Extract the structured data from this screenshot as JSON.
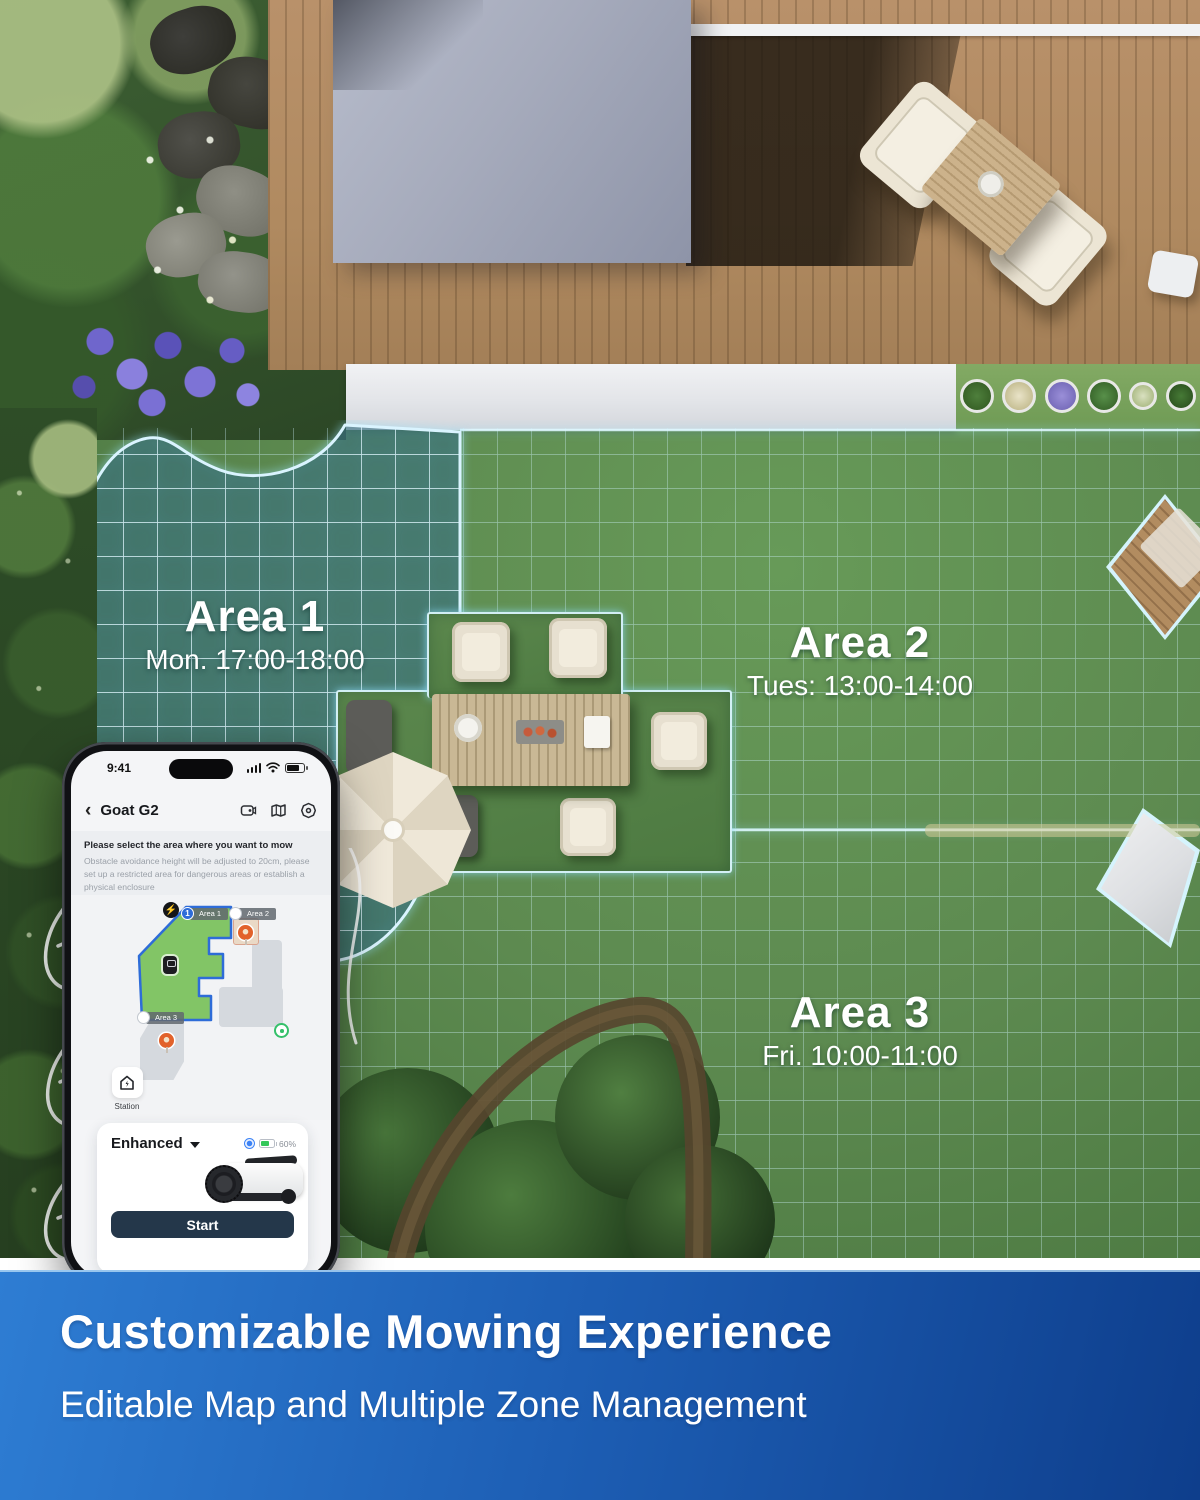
{
  "scene": {
    "areas": [
      {
        "name": "Area 1",
        "schedule": "Mon. 17:00-18:00"
      },
      {
        "name": "Area 2",
        "schedule": "Tues: 13:00-14:00"
      },
      {
        "name": "Area 3",
        "schedule": "Fri. 10:00-11:00"
      }
    ]
  },
  "phone": {
    "status": {
      "time": "9:41"
    },
    "header": {
      "back": "‹",
      "title": "Goat G2"
    },
    "notice": {
      "title": "Please select the area where you want to mow",
      "body": "Obstacle avoidance height will be adjusted to 20cm, please set up a restricted area for dangerous areas or establish a physical enclosure"
    },
    "map": {
      "area1": {
        "index": "1",
        "label": "Area 1"
      },
      "area2": {
        "label": "Area 2"
      },
      "area3": {
        "label": "Area 3"
      },
      "station_label": "Station",
      "bolt": "⚡"
    },
    "controls": {
      "mode": "Enhanced",
      "battery": "60%",
      "start_label": "Start"
    }
  },
  "banner": {
    "title": "Customizable Mowing Experience",
    "subtitle": "Editable Map and Multiple Zone Management"
  },
  "colors": {
    "grid_cyan": "#cfeffc",
    "app_area_green": "#82c566",
    "accent_blue": "#2e6cd8",
    "battery_green": "#34c759",
    "start_button": "#24374a",
    "banner_gradient_start": "#2e7dd3",
    "banner_gradient_end": "#0e3e8c"
  }
}
